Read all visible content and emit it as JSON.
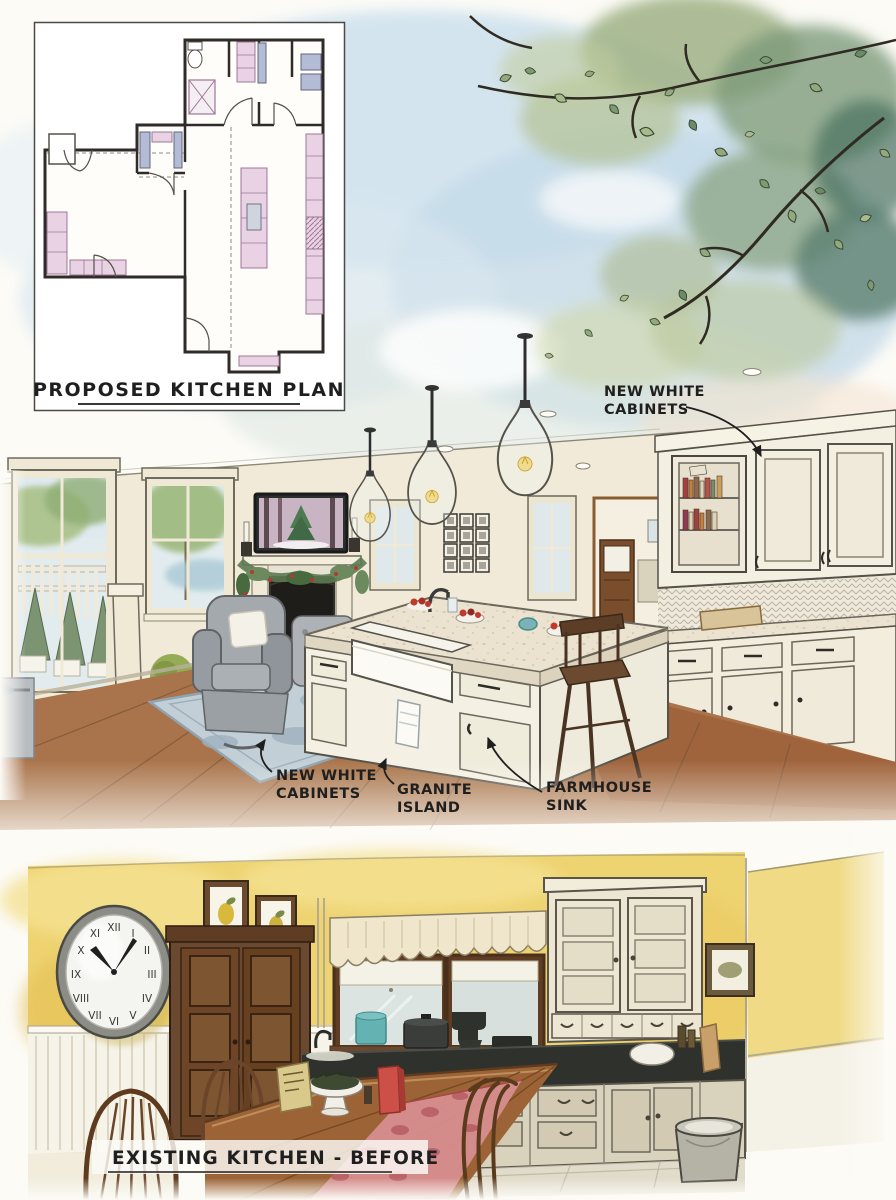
{
  "plan": {
    "label": "PROPOSED KITCHEN PLAN"
  },
  "proposed": {
    "annotations": {
      "upper_cabinets": {
        "line1": "NEW WHITE",
        "line2": "CABINETS"
      },
      "lower_cabinets": {
        "line1": "NEW WHITE",
        "line2": "CABINETS"
      },
      "island": {
        "line1": "GRANITE",
        "line2": "ISLAND"
      },
      "sink": {
        "line1": "FARMHOUSE",
        "line2": "SINK"
      }
    }
  },
  "before": {
    "label": "EXISTING KITCHEN - BEFORE",
    "clock": {
      "numerals": [
        "XII",
        "I",
        "II",
        "III",
        "IV",
        "V",
        "VI",
        "VII",
        "VIII",
        "IX",
        "X",
        "XI"
      ]
    }
  },
  "colors": {
    "paper": "#fcfbf6",
    "sky_blue": "#cfe2ee",
    "leaf_green": "#9fb285",
    "leaf_dark": "#5d8070",
    "plan_pink": "#e9d2e4",
    "plan_blue": "#b3bcd4",
    "wall_cream": "#f1ead8",
    "wood_floor": "#a9744b",
    "rug_blue": "#c2cfd6",
    "chair_gray": "#a3a9ad",
    "granite": "#ebe3d0",
    "cabinet_white": "#f3efe1",
    "wall_yellow": "#eed371",
    "door_brown": "#6b4930",
    "counter_black": "#2e312c",
    "table_wood": "#9c6436",
    "runner_red": "#d98f93",
    "accent_red": "#c0392b",
    "teal": "#64b2b2",
    "ink": "#1f1f1f"
  }
}
